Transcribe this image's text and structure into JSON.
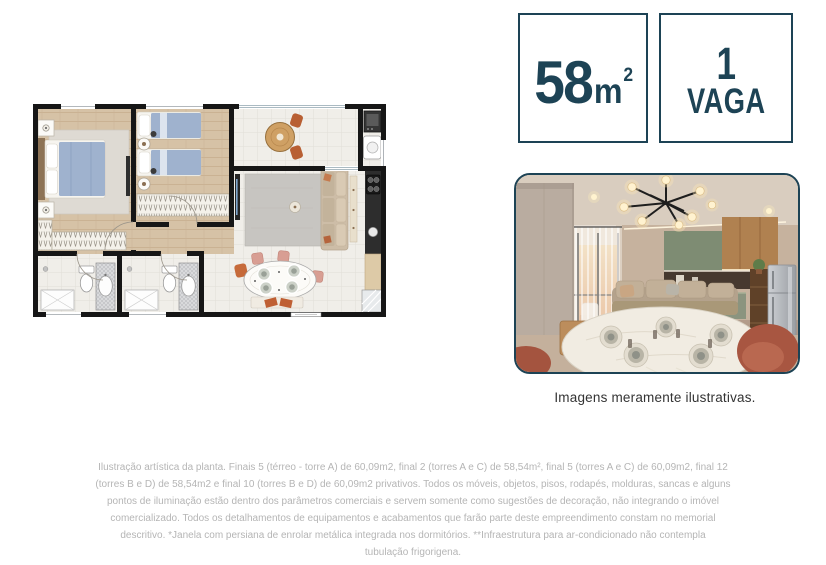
{
  "colors": {
    "accent_navy": "#1d4355",
    "disclaimer_gray": "#b5b5b5",
    "wall_black": "#161616",
    "bed_blue": "#9fb2ce",
    "terracotta": "#b85f33",
    "wood_floor": "#d6c2a6"
  },
  "badges": {
    "area": {
      "value": "58",
      "unit": "m",
      "unit_sup": "2"
    },
    "parking": {
      "value": "1",
      "label": "VAGA"
    }
  },
  "photo": {
    "caption": "Imagens meramente ilustrativas."
  },
  "disclaimer": {
    "lines": [
      "Ilustração artística da planta. Finais 5 (térreo - torre A) de 60,09m2, final 2 (torres A e C) de 58,54m², final 5 (torres A e C) de 60,09m2, final 12",
      "(torres B e D) de 58,54m2 e final 10 (torres B e D) de 60,09m2 privativos. Todos os móveis, objetos, pisos, rodapés, molduras, sancas e alguns",
      "pontos de iluminação estão dentro dos parâmetros comerciais e servem somente como sugestões de decoração, não integrando o imóvel",
      "comercializado. Todos os detalhamentos de equipamentos e acabamentos que farão parte deste empreendimento constam no memorial",
      "descritivo. *Janela com persiana de enrolar metálica integrada nos dormitórios. **Infraestrutura para ar-condicionado não contempla",
      "tubulação frigorigena."
    ]
  }
}
